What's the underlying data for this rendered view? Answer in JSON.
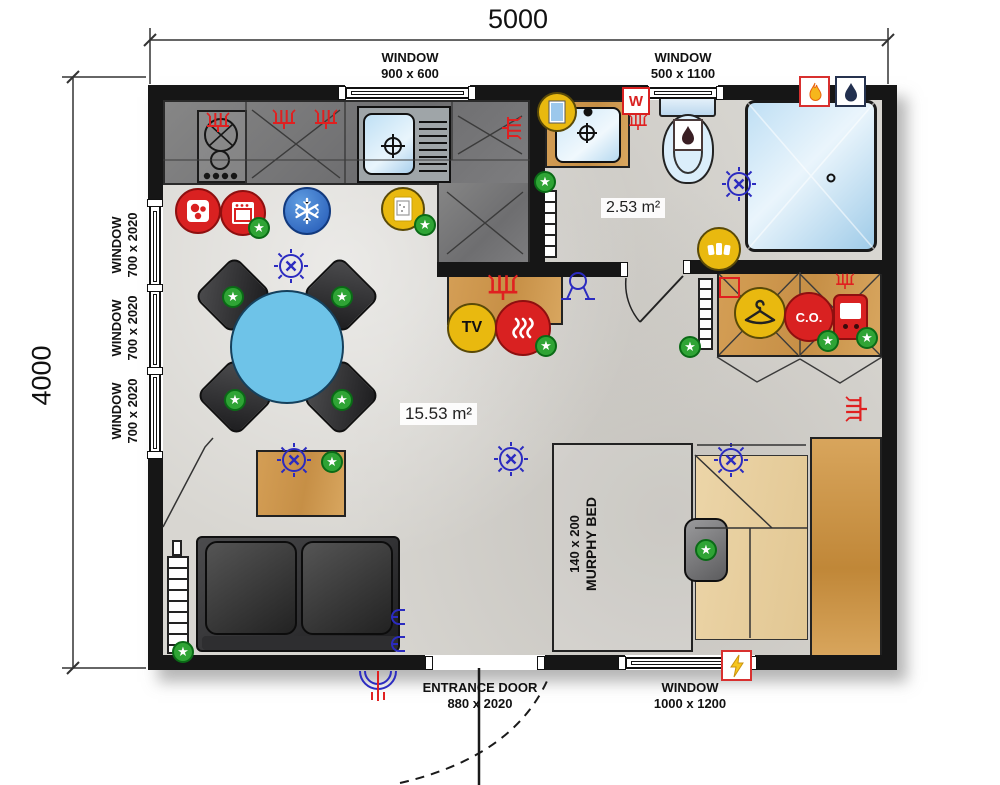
{
  "plan": {
    "dim_top": "5000",
    "dim_left": "4000",
    "main_area": "15.53 m²",
    "bath_area": "2.53 m²"
  },
  "openings": {
    "win_top_left": {
      "label": "WINDOW",
      "size": "900 x 600"
    },
    "win_top_right": {
      "label": "WINDOW",
      "size": "500 x 1100"
    },
    "win_left_top": {
      "label": "WINDOW",
      "size": "700 x 2020"
    },
    "win_left_mid": {
      "label": "WINDOW",
      "size": "700 x 2020"
    },
    "win_left_bottom": {
      "label": "WINDOW",
      "size": "700 x 2020"
    },
    "entrance": {
      "label": "ENTRANCE DOOR",
      "size": "880 x 2020"
    },
    "win_bottom": {
      "label": "WINDOW",
      "size": "1000 x 1200"
    }
  },
  "furniture": {
    "murphy_bed": {
      "size": "140 x 200",
      "label": "MURPHY BED"
    }
  },
  "badges": {
    "tv": "TV",
    "carbon_monoxide": "C.O.",
    "washing_machine": "W"
  },
  "icons": {
    "star": "★"
  },
  "colors": {
    "wall": "#161616",
    "counter": "#7c7c7c",
    "wood": "#cf9a52",
    "wood_light": "#e9d2a6",
    "table_blue": "#6ec3e8",
    "water_blue": "#cde7f8",
    "accent_red": "#d92121",
    "accent_yellow": "#e9b90f",
    "accent_green": "#2fa435",
    "symbol_blue": "#2b2bc0",
    "navy": "#22304f"
  }
}
